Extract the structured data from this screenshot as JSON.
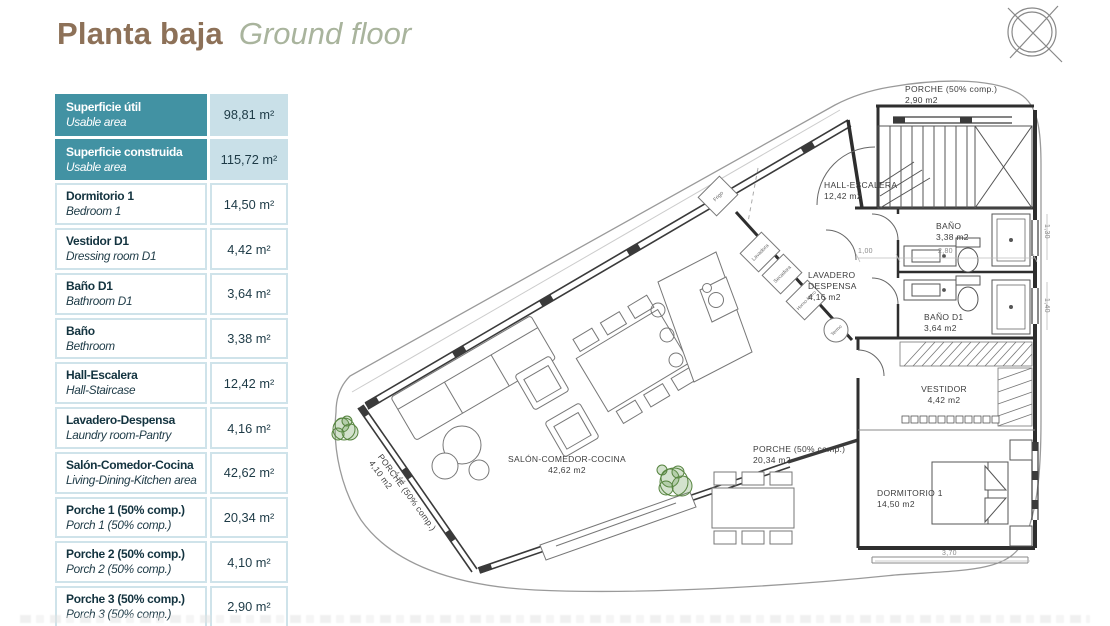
{
  "title": {
    "main": "Planta baja",
    "sub": "Ground floor"
  },
  "legend_table": {
    "rows": [
      {
        "es": "Superficie útil",
        "en": "Usable area",
        "value": "98,81 m²",
        "highlight": true
      },
      {
        "es": "Superficie construida",
        "en": "Usable area",
        "value": "115,72 m²",
        "highlight": true
      },
      {
        "es": "Dormitorio 1",
        "en": "Bedroom 1",
        "value": "14,50 m²",
        "highlight": false
      },
      {
        "es": "Vestidor D1",
        "en": "Dressing room D1",
        "value": "4,42 m²",
        "highlight": false
      },
      {
        "es": "Baño D1",
        "en": "Bathroom D1",
        "value": "3,64 m²",
        "highlight": false
      },
      {
        "es": "Baño",
        "en": "Bethroom",
        "value": "3,38 m²",
        "highlight": false
      },
      {
        "es": "Hall-Escalera",
        "en": "Hall-Staircase",
        "value": "12,42 m²",
        "highlight": false
      },
      {
        "es": "Lavadero-Despensa",
        "en": "Laundry room-Pantry",
        "value": "4,16 m²",
        "highlight": false
      },
      {
        "es": "Salón-Comedor-Cocina",
        "en": "Living-Dining-Kitchen area",
        "value": "42,62 m²",
        "highlight": false
      },
      {
        "es": "Porche 1 (50% comp.)",
        "en": "Porch 1 (50% comp.)",
        "value": "20,34 m²",
        "highlight": false
      },
      {
        "es": "Porche 2 (50% comp.)",
        "en": "Porch 2 (50% comp.)",
        "value": "4,10 m²",
        "highlight": false
      },
      {
        "es": "Porche 3 (50% comp.)",
        "en": "Porch 3 (50% comp.)",
        "value": "2,90 m²",
        "highlight": false
      }
    ]
  },
  "plan": {
    "rooms": [
      {
        "name": "PORCHE (50% comp.)",
        "area": "2,90 m2"
      },
      {
        "name": "HALL-ESCALERA",
        "area": "12,42 m2"
      },
      {
        "name": "BAÑO",
        "area": "3,38 m2"
      },
      {
        "name": "LAVADERO DESPENSA",
        "area": "4,16 m2"
      },
      {
        "name": "BAÑO D1",
        "area": "3,64 m2"
      },
      {
        "name": "VESTIDOR",
        "area": "4,42 m2"
      },
      {
        "name": "DORMITORIO 1",
        "area": "14,50 m2"
      },
      {
        "name": "SALÓN-COMEDOR-COCINA",
        "area": "42,62 m2"
      },
      {
        "name": "PORCHE (50% comp.)",
        "area": "20,34 m2"
      },
      {
        "name": "PORCHE (50% comp.)",
        "area": "4,10 m2"
      }
    ],
    "dimensions": [
      "4,44",
      "3,70",
      "1,00",
      "2,80",
      "1,30",
      "1,40"
    ],
    "fixtures": [
      "Frigo",
      "Lavadora",
      "Secadora",
      "Horno-Micro",
      "Termo"
    ]
  },
  "colors": {
    "teal": "#4292a3",
    "cell_border": "#cfe3ea",
    "value_bg": "#c9e0e8",
    "title_brown": "#8d7158",
    "subtitle_green": "#a9b49d",
    "plant_green": "#56843f"
  }
}
